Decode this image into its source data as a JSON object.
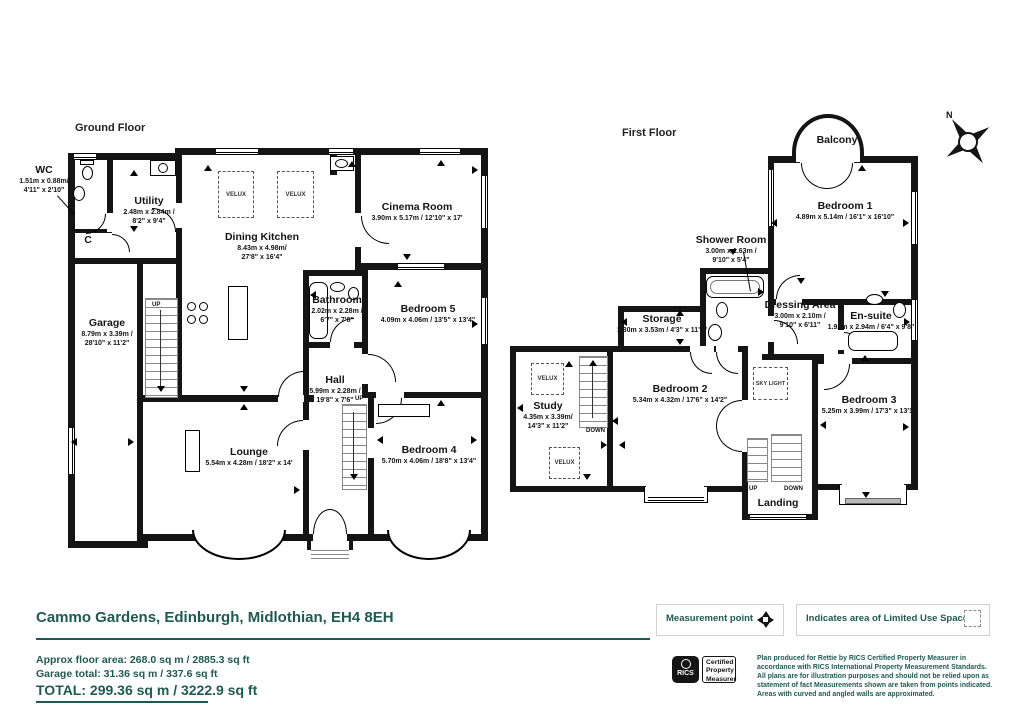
{
  "titles": {
    "ground_floor": "Ground Floor",
    "first_floor": "First Floor"
  },
  "compass": {
    "north_label": "N"
  },
  "ground_floor": {
    "labels": {
      "velux": "VELUX",
      "up": "UP"
    },
    "rooms": {
      "wc": {
        "name": "WC",
        "dims_m": "1.51m x 0.88m/",
        "dims_ft": "4'11\" x 2'10\""
      },
      "cupboard": {
        "name": "C"
      },
      "utility": {
        "name": "Utility",
        "dims_m": "2.48m x 2.84m /",
        "dims_ft": "8'2\" x 9'4\""
      },
      "dining_kitchen": {
        "name": "Dining Kitchen",
        "dims_m": "8.43m x 4.98m/",
        "dims_ft": "27'8\" x 16'4\""
      },
      "cinema_room": {
        "name": "Cinema Room",
        "dims": "3.90m x 5.17m / 12'10\" x 17'"
      },
      "bathroom": {
        "name": "Bathroom",
        "dims_m": "2.02m x 2.28m /",
        "dims_ft": "6'7\" x 7'6\""
      },
      "bedroom5": {
        "name": "Bedroom 5",
        "dims": "4.09m x 4.06m / 13'5\" x 13'4\""
      },
      "garage": {
        "name": "Garage",
        "dims_m": "8.79m x 3.39m /",
        "dims_ft": "28'10\" x 11'2\""
      },
      "hall": {
        "name": "Hall",
        "dims_m": "5.99m x 2.28m /",
        "dims_ft": "19'8\" x 7'6\""
      },
      "lounge": {
        "name": "Lounge",
        "dims": "5.54m x 4.28m / 18'2\" x 14'"
      },
      "bedroom4": {
        "name": "Bedroom 4",
        "dims": "5.70m x 4.06m / 18'8\" x 13'4\""
      }
    }
  },
  "first_floor": {
    "labels": {
      "velux": "VELUX",
      "sky_light": "SKY LIGHT",
      "up": "UP",
      "down": "DOWN"
    },
    "rooms": {
      "balcony": {
        "name": "Balcony"
      },
      "bedroom1": {
        "name": "Bedroom 1",
        "dims": "4.89m x 5.14m / 16'1\" x 16'10\""
      },
      "shower_room": {
        "name": "Shower Room",
        "dims_m": "3.00m x 1.63m /",
        "dims_ft": "9'10\" x 5'4\""
      },
      "dressing_area": {
        "name": "Dressing Area",
        "dims_m": "3.00m x 2.10m /",
        "dims_ft": "9'10\" x 6'11\""
      },
      "ensuite": {
        "name": "En-suite",
        "dims": "1.92m x 2.94m / 6'4\" x 9'8\""
      },
      "storage": {
        "name": "Storage",
        "dims": "1.30m x 3.53m / 4'3\" x 11'7\""
      },
      "bedroom2": {
        "name": "Bedroom 2",
        "dims": "5.34m x 4.32m / 17'6\" x 14'2\""
      },
      "study": {
        "name": "Study",
        "dims_m": "4.35m x 3.39m/",
        "dims_ft": "14'3\" x 11'2\""
      },
      "bedroom3": {
        "name": "Bedroom 3",
        "dims": "5.25m x 3.99m / 17'3\" x 13'1\""
      },
      "landing": {
        "name": "Landing"
      }
    }
  },
  "footer": {
    "address": "Cammo Gardens, Edinburgh, Midlothian, EH4 8EH",
    "legend": {
      "measurement_point": "Measurement point",
      "limited_use": "Indicates area of  Limited Use Space"
    },
    "areas": {
      "approx": "Approx floor area: 268.0 sq m / 2885.3 sq ft",
      "garage": "Garage total: 31.36 sq m / 337.6 sq ft",
      "total": "TOTAL: 299.36 sq m / 3222.9 sq ft"
    },
    "rics": {
      "logo": "RICS",
      "c1": "Certified",
      "c2": "Property",
      "c3": "Measurer",
      "disclaimer": "Plan produced for Rettie by RICS Certified Property Measurer in accordance with RICS International Property Measurement Standards. All plans are for illustration purposes and should not be relied upon as statement of fact Measurements shown are taken from points indicated. Areas with curved and angled walls are approximated."
    }
  }
}
